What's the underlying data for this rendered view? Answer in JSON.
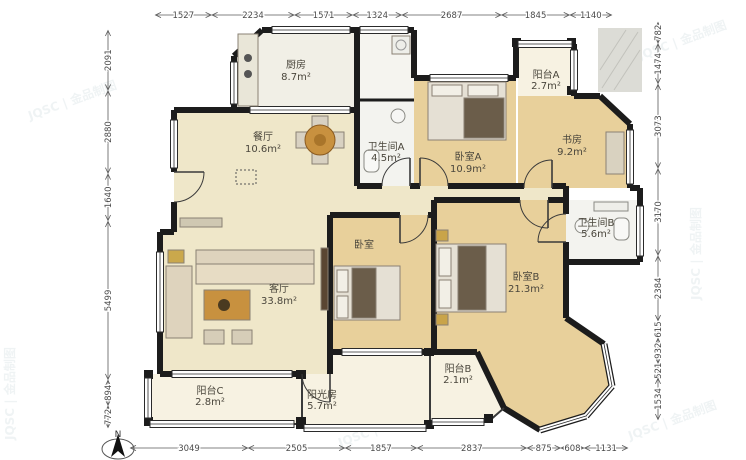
{
  "watermark": {
    "text": "JQSC | 金品制图"
  },
  "north": {
    "label": "N"
  },
  "rooms": {
    "kitchen": {
      "label": "厨房",
      "area": "8.7m²"
    },
    "dining": {
      "label": "餐厅",
      "area": "10.6m²"
    },
    "bath_a": {
      "label": "卫生间A",
      "area": "4.5m²"
    },
    "bedroom_a": {
      "label": "卧室A",
      "area": "10.9m²"
    },
    "balcony_a": {
      "label": "阳台A",
      "area": "2.7m²"
    },
    "study": {
      "label": "书房",
      "area": "9.2m²"
    },
    "bath_b": {
      "label": "卫生间B",
      "area": "5.6m²"
    },
    "bedroom_mid": {
      "label": "卧室",
      "area": ""
    },
    "bedroom_b": {
      "label": "卧室B",
      "area": "21.3m²"
    },
    "living": {
      "label": "客厅",
      "area": "33.8m²"
    },
    "balcony_c": {
      "label": "阳台C",
      "area": "2.8m²"
    },
    "sunroom": {
      "label": "阳光房",
      "area": "5.7m²"
    },
    "balcony_b": {
      "label": "阳台B",
      "area": "2.1m²"
    }
  },
  "dimensions": {
    "top": [
      1527,
      2234,
      1571,
      1324,
      2687,
      1845,
      1140
    ],
    "bottom": [
      3049,
      2505,
      1857,
      2837,
      875,
      608,
      1131
    ],
    "left": [
      2091,
      2880,
      1640,
      5499,
      894,
      772
    ],
    "right": [
      782,
      1474,
      3073,
      3170,
      2384,
      615,
      932,
      521,
      1534
    ]
  }
}
